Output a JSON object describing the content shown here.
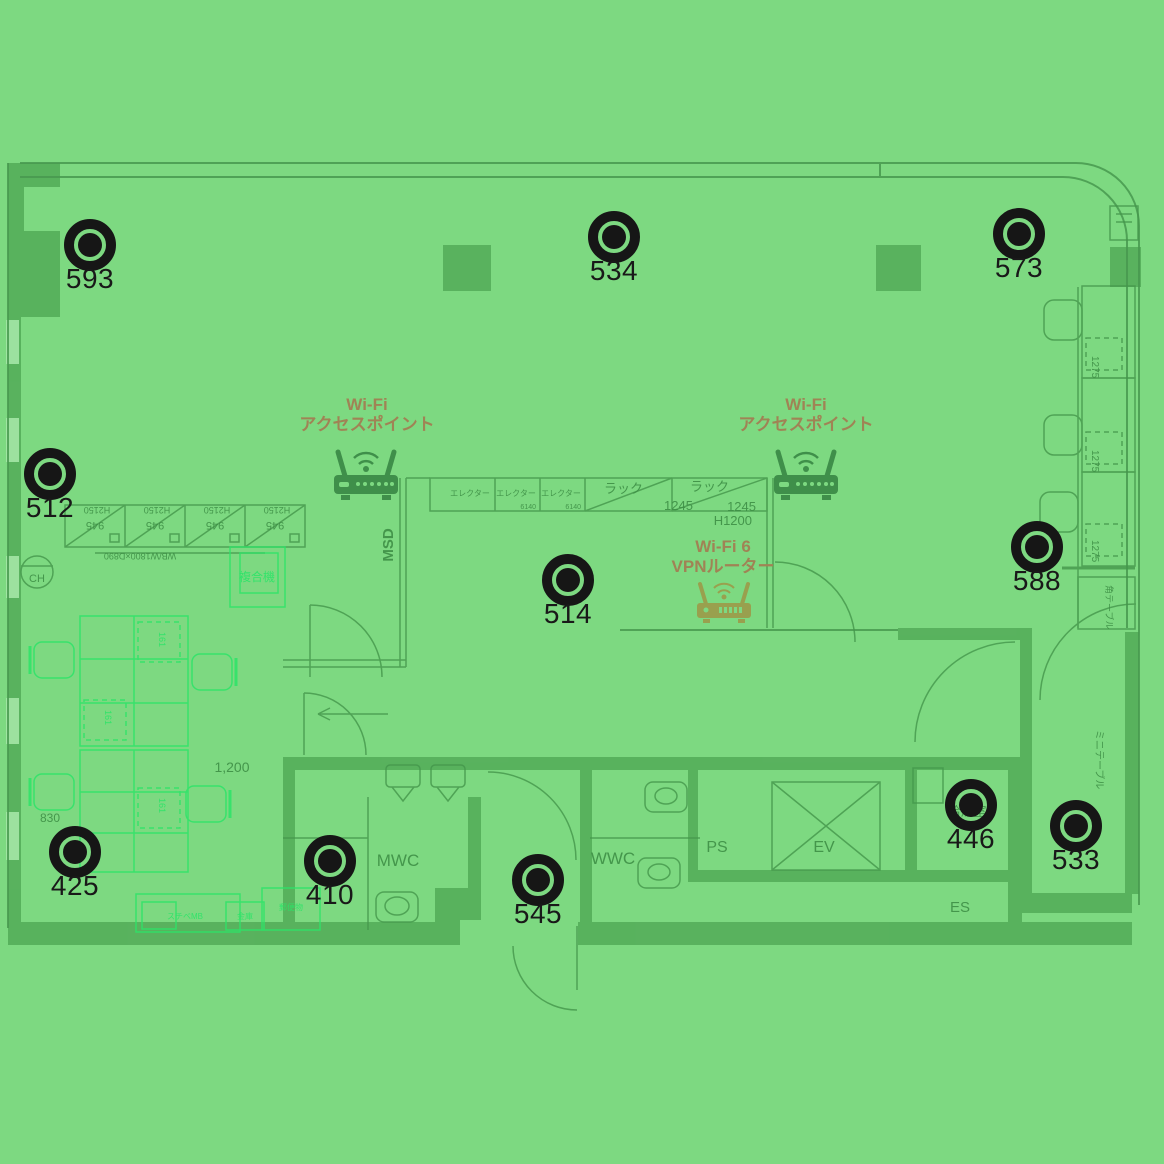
{
  "heatmap": {
    "base_color": "#7dd981",
    "wall_color": "#57b05c",
    "marker_color": "#161616",
    "cad_bright_color": "#2ce468",
    "ap_label_color": "#a08355"
  },
  "measurements": [
    {
      "value": "593",
      "x": 90,
      "y": 245
    },
    {
      "value": "534",
      "x": 614,
      "y": 237
    },
    {
      "value": "573",
      "x": 1019,
      "y": 234
    },
    {
      "value": "512",
      "x": 50,
      "y": 474
    },
    {
      "value": "514",
      "x": 568,
      "y": 580
    },
    {
      "value": "588",
      "x": 1037,
      "y": 547
    },
    {
      "value": "425",
      "x": 75,
      "y": 852
    },
    {
      "value": "410",
      "x": 330,
      "y": 861
    },
    {
      "value": "545",
      "x": 538,
      "y": 880
    },
    {
      "value": "446",
      "x": 971,
      "y": 805
    },
    {
      "value": "533",
      "x": 1076,
      "y": 826
    }
  ],
  "access_points": [
    {
      "label_line1": "Wi-Fi",
      "label_line2": "アクセスポイント"
    },
    {
      "label_line1": "Wi-Fi",
      "label_line2": "アクセスポイント"
    },
    {
      "label_line1": "Wi-Fi 6",
      "label_line2": "VPNルーター"
    }
  ],
  "floorplan": {
    "room_labels": {
      "mwc": "MWC",
      "wwc": "WWC",
      "ps": "PS",
      "ev": "EV",
      "es": "ES",
      "kitchenette": "給湯室",
      "msd": "MSD",
      "ch": "CH"
    },
    "furniture_labels": {
      "copier": "複合機",
      "corner_table": "角テーブル",
      "mini_table": "ミニテーブル",
      "shelf": "エレクター",
      "rack": "ラック",
      "cabinet": "スチベMB",
      "safe": "金庫",
      "mail": "郵便物"
    },
    "dimension_labels": {
      "cab_w": "945",
      "cab_h": "H2150",
      "whiteboard": "WB/W1800×D890",
      "shelf_d": "6140",
      "rack_w": "1245",
      "rack_h": "H1200",
      "aisle": "1,200",
      "wall": "830",
      "desk": "1275",
      "sub": "161"
    }
  }
}
